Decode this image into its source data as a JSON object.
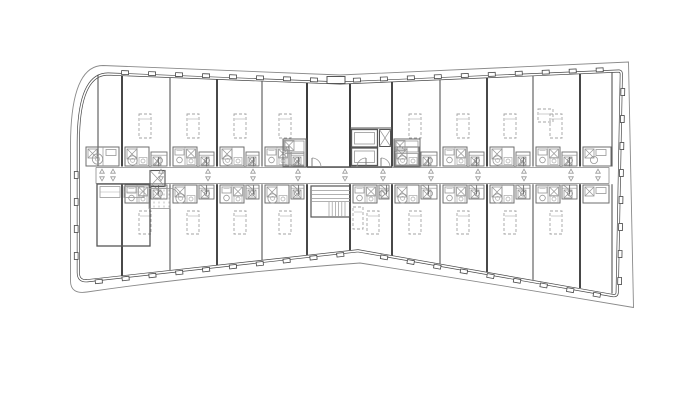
{
  "canvas": {
    "width": 700,
    "height": 420,
    "background": "#ffffff"
  },
  "palette": {
    "wall": "#565656",
    "wall_heavy": "#3e3e3e",
    "medium": "#6e6e6e",
    "light": "#979797",
    "faint": "#aaaaaa",
    "dashed": "#a3a3a3",
    "white": "#ffffff",
    "facade": "#474747",
    "overhang": "#8a8a8a"
  },
  "plan": {
    "outline": {
      "facade_path": "M 108 74 L 340 83 L 619 71 Q 621.5 71.3 621.3 74.5 L 617.2 292.5 Q 617 296.2 613 295.6 L 358 250.8 L 87.5 280.7 Q 78.3 281.7 78.3 272.5 L 78.3 143 Q 78.3 74 108 74 Z",
      "overhang_path": "M 103 65.5 L 340 75 L 628.5 62 L 633.5 307.5 Q 500 285 360 263 Q 215 273.5 87 292 Q 70.5 294.5 70.5 281 L 70.5 146 Q 70.5 65.5 103 65.5 Z"
    },
    "top_edge": {
      "x0": 108,
      "y0": 74,
      "xm": 340,
      "ym": 83,
      "x1": 619,
      "y1": 71
    },
    "bottom_edge": {
      "x0": 86,
      "y0": 281,
      "xm": 357,
      "ym": 250.8,
      "x1": 615,
      "y1": 295.5
    },
    "mullion": {
      "spacing": 27,
      "w": 7,
      "h": 3.8,
      "start": 13
    },
    "facade_segments": [
      {
        "x1": 112,
        "y1": 74.2,
        "x2": 336,
        "y2": 82.8,
        "out": "up"
      },
      {
        "x1": 344,
        "y1": 82.7,
        "x2": 615,
        "y2": 71.3,
        "out": "up"
      },
      {
        "x1": 620.9,
        "y1": 79,
        "x2": 617.4,
        "y2": 289,
        "out": "right"
      },
      {
        "x1": 610,
        "y1": 295,
        "x2": 362,
        "y2": 251.3,
        "out": "down"
      },
      {
        "x1": 353,
        "y1": 251.3,
        "x2": 91,
        "y2": 280.2,
        "out": "down"
      },
      {
        "x1": 78.3,
        "y1": 269,
        "x2": 78.3,
        "y2": 146,
        "out": "left"
      }
    ],
    "corridor": {
      "x1": 96,
      "x2": 609,
      "y_top": 167.4,
      "y_bottom": 183.6
    },
    "partitions_top": [
      {
        "x": 98,
        "heavy": false
      },
      {
        "x": 122,
        "heavy": true
      },
      {
        "x": 170,
        "heavy": false
      },
      {
        "x": 217,
        "heavy": true
      },
      {
        "x": 262,
        "heavy": false
      },
      {
        "x": 307,
        "heavy": true
      },
      {
        "x": 350,
        "heavy": true
      },
      {
        "x": 392,
        "heavy": true
      },
      {
        "x": 440,
        "heavy": false
      },
      {
        "x": 487,
        "heavy": true
      },
      {
        "x": 533,
        "heavy": false
      },
      {
        "x": 580,
        "heavy": true
      },
      {
        "x": 612,
        "heavy": false
      }
    ],
    "partitions_bottom": [
      {
        "x": 122,
        "heavy": true
      },
      {
        "x": 170,
        "heavy": false
      },
      {
        "x": 217,
        "heavy": true
      },
      {
        "x": 262,
        "heavy": false
      },
      {
        "x": 307,
        "heavy": true
      },
      {
        "x": 350,
        "heavy": true
      },
      {
        "x": 392,
        "heavy": true
      },
      {
        "x": 440,
        "heavy": false
      },
      {
        "x": 487,
        "heavy": true
      },
      {
        "x": 533,
        "heavy": false
      },
      {
        "x": 580,
        "heavy": true
      },
      {
        "x": 612,
        "heavy": false
      }
    ],
    "units_top": [
      {
        "x": 84,
        "w": 38,
        "kind": "end-left"
      },
      {
        "x": 122,
        "w": 48,
        "v": 1
      },
      {
        "x": 170,
        "w": 47,
        "v": 0
      },
      {
        "x": 217,
        "w": 45,
        "v": 1
      },
      {
        "x": 262,
        "w": 45,
        "v": 0
      },
      {
        "x": 392,
        "w": 48,
        "v": 1
      },
      {
        "x": 440,
        "w": 47,
        "v": 0
      },
      {
        "x": 487,
        "w": 46,
        "v": 1
      },
      {
        "x": 533,
        "w": 47,
        "v": 0
      },
      {
        "x": 580,
        "w": 33,
        "kind": "end-right"
      }
    ],
    "units_bottom": [
      {
        "x": 122,
        "w": 48,
        "v": 0
      },
      {
        "x": 170,
        "w": 47,
        "v": 1
      },
      {
        "x": 217,
        "w": 45,
        "v": 0
      },
      {
        "x": 262,
        "w": 45,
        "v": 1
      },
      {
        "x": 350,
        "w": 42,
        "v": 0
      },
      {
        "x": 392,
        "w": 48,
        "v": 1
      },
      {
        "x": 440,
        "w": 47,
        "v": 0
      },
      {
        "x": 487,
        "w": 46,
        "v": 1
      },
      {
        "x": 533,
        "w": 47,
        "v": 0
      },
      {
        "x": 580,
        "w": 32,
        "kind": "end-right"
      }
    ],
    "triangles_x": [
      102,
      113,
      161,
      208,
      253,
      298,
      345,
      383,
      431,
      478,
      524,
      571,
      598
    ],
    "core": {
      "left_wall_x": 307,
      "right_wall_x": 350,
      "lobby_wall_x": 392,
      "corridor_wall_y": 167,
      "lobby_line_y": 128,
      "elevators": [
        {
          "x": 351.5,
          "y": 129.5,
          "w": 26,
          "h": 17.5
        },
        {
          "x": 351.5,
          "y": 148,
          "w": 26,
          "h": 17.5
        }
      ],
      "duct": {
        "x": 379.5,
        "y": 129.5,
        "w": 11,
        "h": 17
      },
      "counter_left": {
        "x": 283,
        "y": 139,
        "w": 23,
        "h": 28
      },
      "counter_right": {
        "x": 394,
        "y": 139,
        "w": 26,
        "h": 28
      },
      "facade_notch": {
        "x": 327,
        "y": 76.5,
        "w": 18,
        "h": 7
      }
    },
    "stair": {
      "x": 311,
      "y": 186,
      "w": 39,
      "h": 31,
      "rail_ys": [
        190.5,
        194.5,
        198.5
      ],
      "divider_y": 201.5,
      "tread_x1": 329,
      "tread_x2": 348,
      "tread_step": 3.2,
      "tread_y1": 202,
      "tread_y2": 217
    },
    "left_block": {
      "outer": {
        "x": 97,
        "y": 184,
        "w": 53,
        "h": 62
      },
      "divider_x": 122,
      "top_cells": [
        {
          "x": 100,
          "y": 186.5,
          "w": 20,
          "h": 11
        },
        {
          "x": 124,
          "y": 186.5,
          "w": 20,
          "h": 11
        }
      ],
      "shaft": {
        "x": 150,
        "y": 170.5,
        "w": 15,
        "h": 16
      },
      "storage": {
        "x": 149,
        "y": 188.5,
        "w": 21,
        "h": 20
      },
      "storage_dash_xs": [
        154,
        159,
        164,
        169
      ]
    },
    "extra_dashed": [
      {
        "x": 538,
        "y": 109,
        "w": 15,
        "h": 13
      },
      {
        "x": 353,
        "y": 207,
        "w": 10,
        "h": 22
      }
    ],
    "geometry_units": {
      "pod_top_y": 147,
      "pod_bottom_y": 185,
      "pod_w": 24,
      "pod_h": 19,
      "pod_h_bottom": 18,
      "bed_top": {
        "dx": 17,
        "y": 114,
        "w": 12,
        "h": 24
      },
      "bed_bottom": {
        "dx": 17,
        "y": 211,
        "w": 12,
        "h": 23
      }
    }
  }
}
